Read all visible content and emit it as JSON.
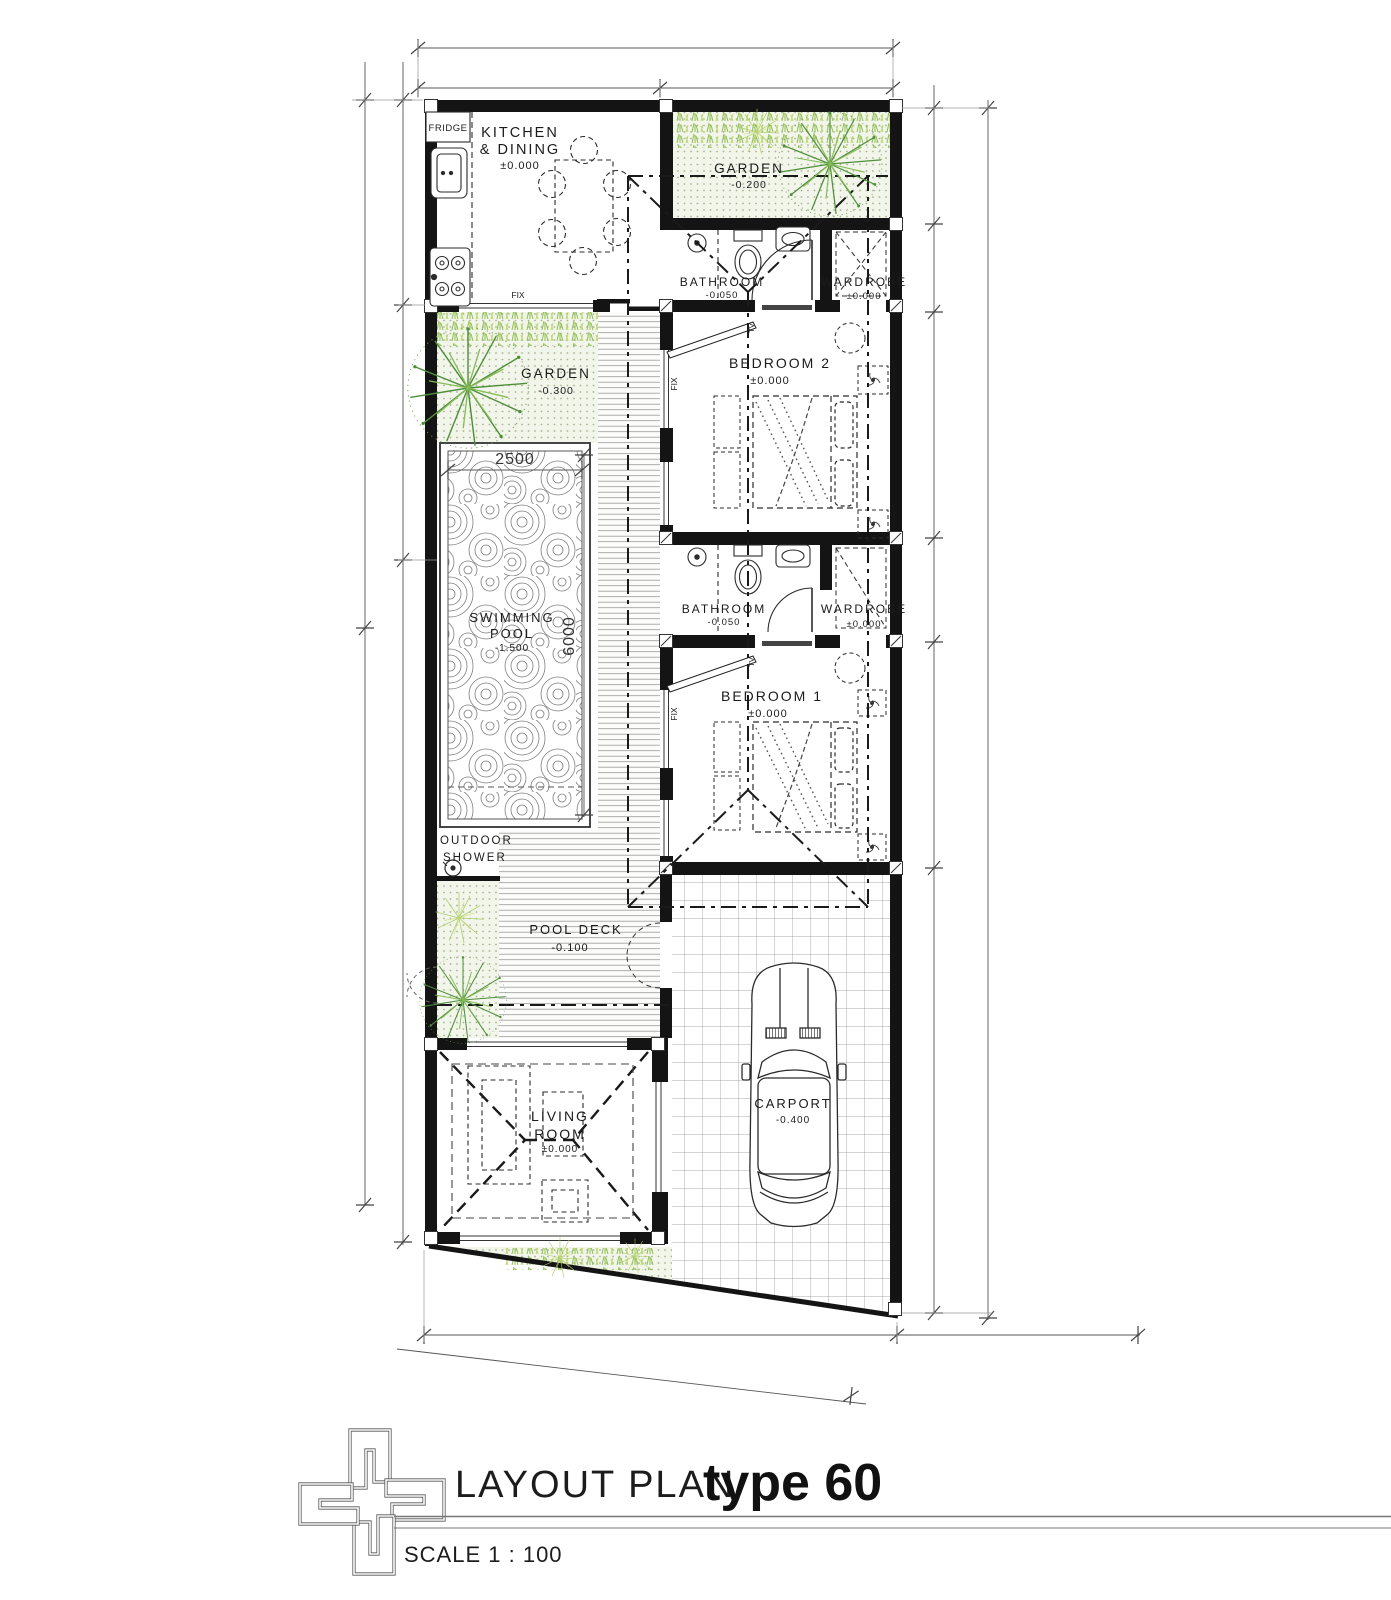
{
  "document": {
    "title": "LAYOUT PLAN",
    "type_label": "type 60",
    "scale": "SCALE 1 : 100"
  },
  "rooms": {
    "kitchen_dining": {
      "line1": "KITCHEN",
      "line2": "& DINING",
      "level": "±0.000"
    },
    "garden_top": {
      "name": "GARDEN",
      "level": "-0.200"
    },
    "bathroom_top": {
      "name": "BATHROOM",
      "level": "-0.050"
    },
    "wardrobe_top": {
      "name": "WARDROBE",
      "level": "±0.000"
    },
    "bedroom_2": {
      "name": "BEDROOM 2",
      "level": "±0.000"
    },
    "garden_side": {
      "name": "GARDEN",
      "level": "-0.300"
    },
    "swimming_pool": {
      "line1": "SWIMMING",
      "line2": "POOL",
      "level": "-1.500"
    },
    "bathroom_mid": {
      "name": "BATHROOM",
      "level": "-0.050"
    },
    "wardrobe_mid": {
      "name": "WARDROBE",
      "level": "±0.000"
    },
    "bedroom_1": {
      "name": "BEDROOM 1",
      "level": "±0.000"
    },
    "outdoor_shower": {
      "line1": "OUTDOOR",
      "line2": "SHOWER"
    },
    "pool_deck": {
      "name": "POOL DECK",
      "level": "-0.100"
    },
    "living_room": {
      "line1": "LIVING",
      "line2": "ROOM",
      "level": "±0.000"
    },
    "carport": {
      "name": "CARPORT",
      "level": "-0.400"
    }
  },
  "dimensions": {
    "pool_width": "2500",
    "pool_length": "6000"
  },
  "labels": {
    "fridge": "FRIDGE",
    "fix": "FIX",
    "tv": "TV"
  },
  "colors": {
    "wall": "#141414",
    "line": "#2b2b2b",
    "vegetation": "#5c953e",
    "vegetation_light": "#a8cc62",
    "garden_bg": "#f2f5ea",
    "paper": "#ffffff"
  }
}
